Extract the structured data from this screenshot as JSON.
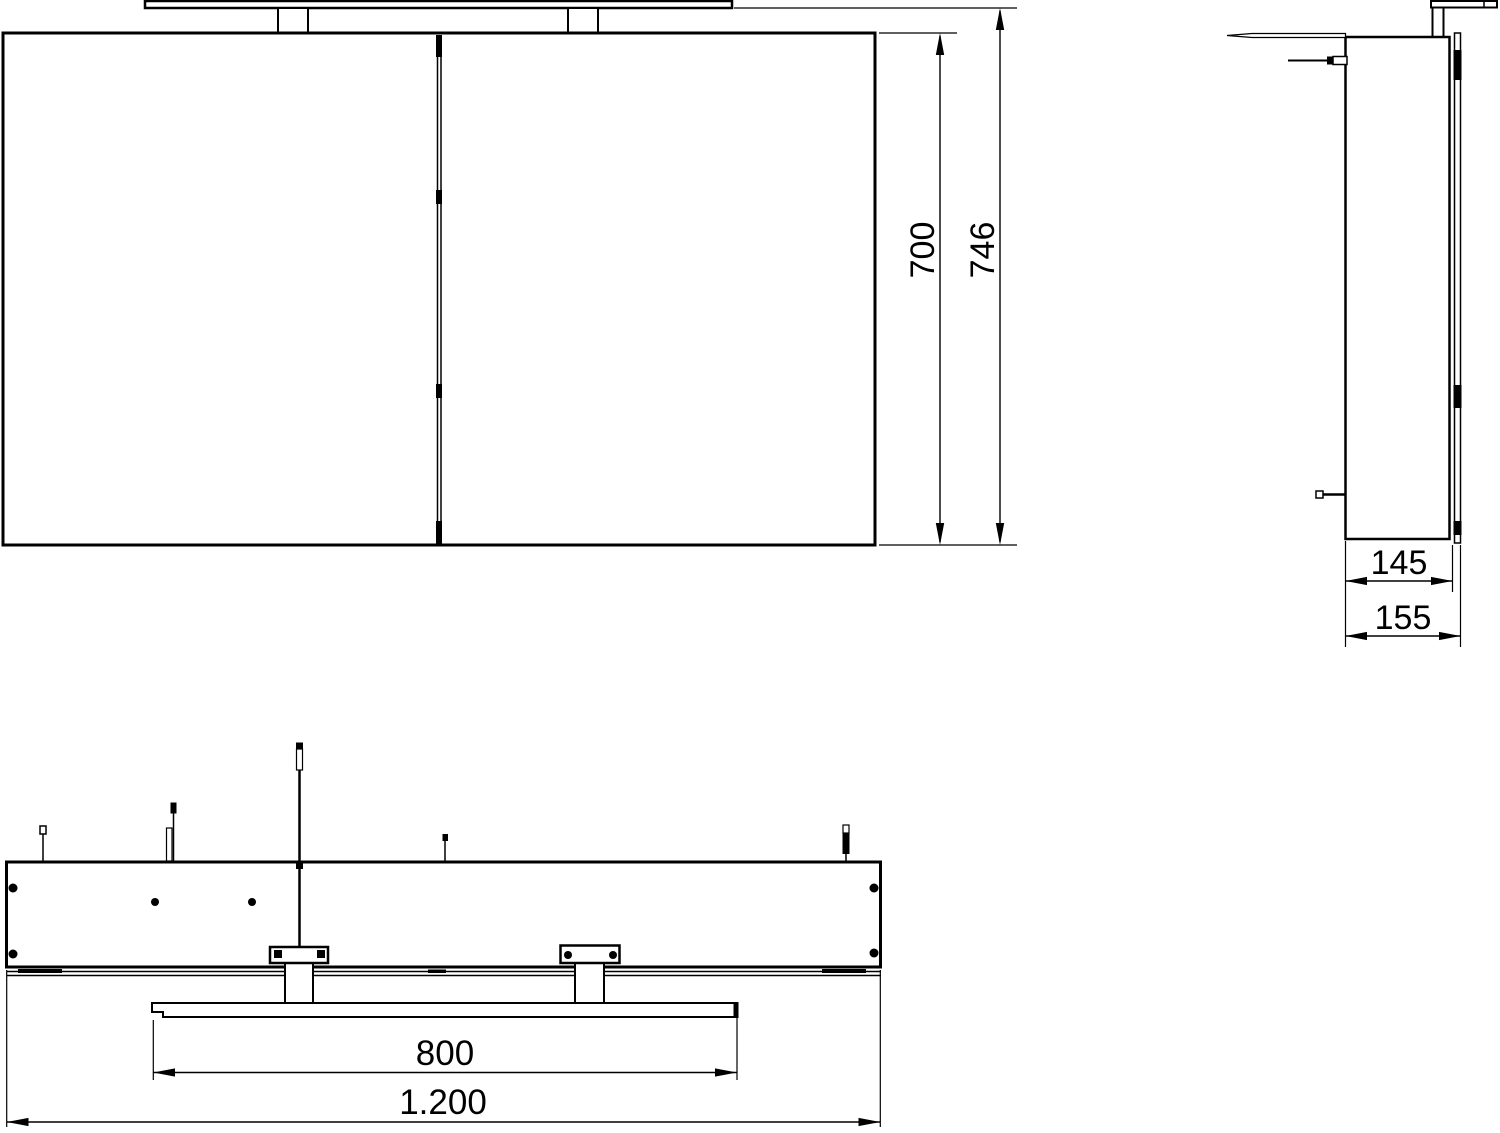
{
  "drawing": {
    "background_color": "#ffffff",
    "line_color": "#000000",
    "dimensions": {
      "cabinet_height": "700",
      "total_height_with_light": "746",
      "cabinet_depth": "145",
      "total_depth": "155",
      "light_bar_width": "800",
      "total_width": "1.200"
    }
  }
}
